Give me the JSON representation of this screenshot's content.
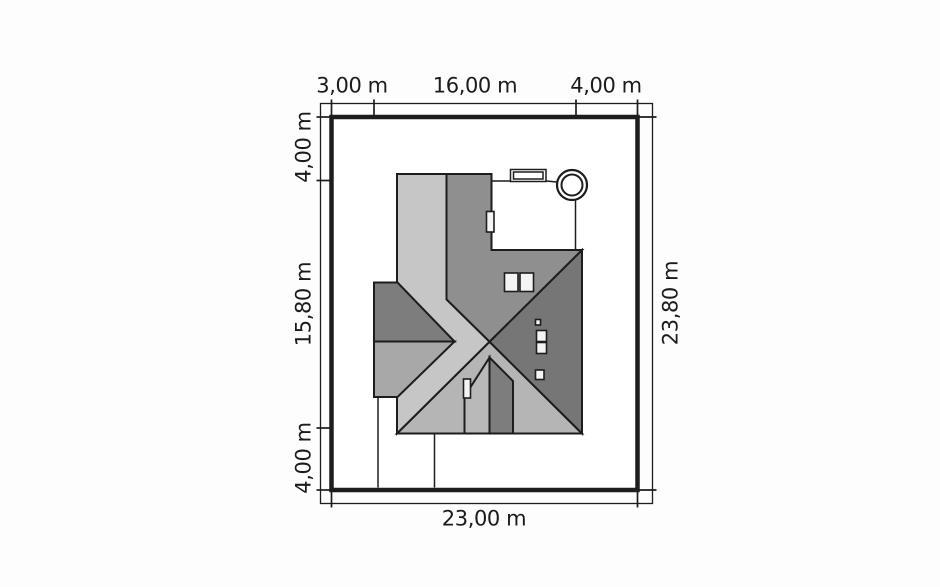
{
  "plan_type": "architectural site plan (roof view)",
  "dimensions": {
    "top": [
      "3,00 m",
      "16,00 m",
      "4,00 m"
    ],
    "left": [
      "4,00 m",
      "15,80 m",
      "4,00 m"
    ],
    "right": [
      "23,80 m"
    ],
    "bottom": [
      "23,00 m"
    ]
  },
  "colors": {
    "line": "#1d1d1d",
    "bg": "#fdfdfd",
    "surface": "#ffffff",
    "detail": "#f4f4f4",
    "roof": {
      "band": "#c6c6c6",
      "bottom": "#b5b5b5",
      "top": "#8f8f8f",
      "right": "#767676",
      "wingTop": "#7d7d7d",
      "wingBottom": "#a8a8a8",
      "dormerLight": "#b9b9b9",
      "dormerDark": "#7d7d7d"
    }
  },
  "icons": {
    "well": "double-circle symbol at top-right of courtyard",
    "skylight": "double-rectangle symbol on courtyard edge",
    "chimney": "small white rectangle on dormer slope",
    "roof_windows": "two white rectangles on upper roof face"
  }
}
